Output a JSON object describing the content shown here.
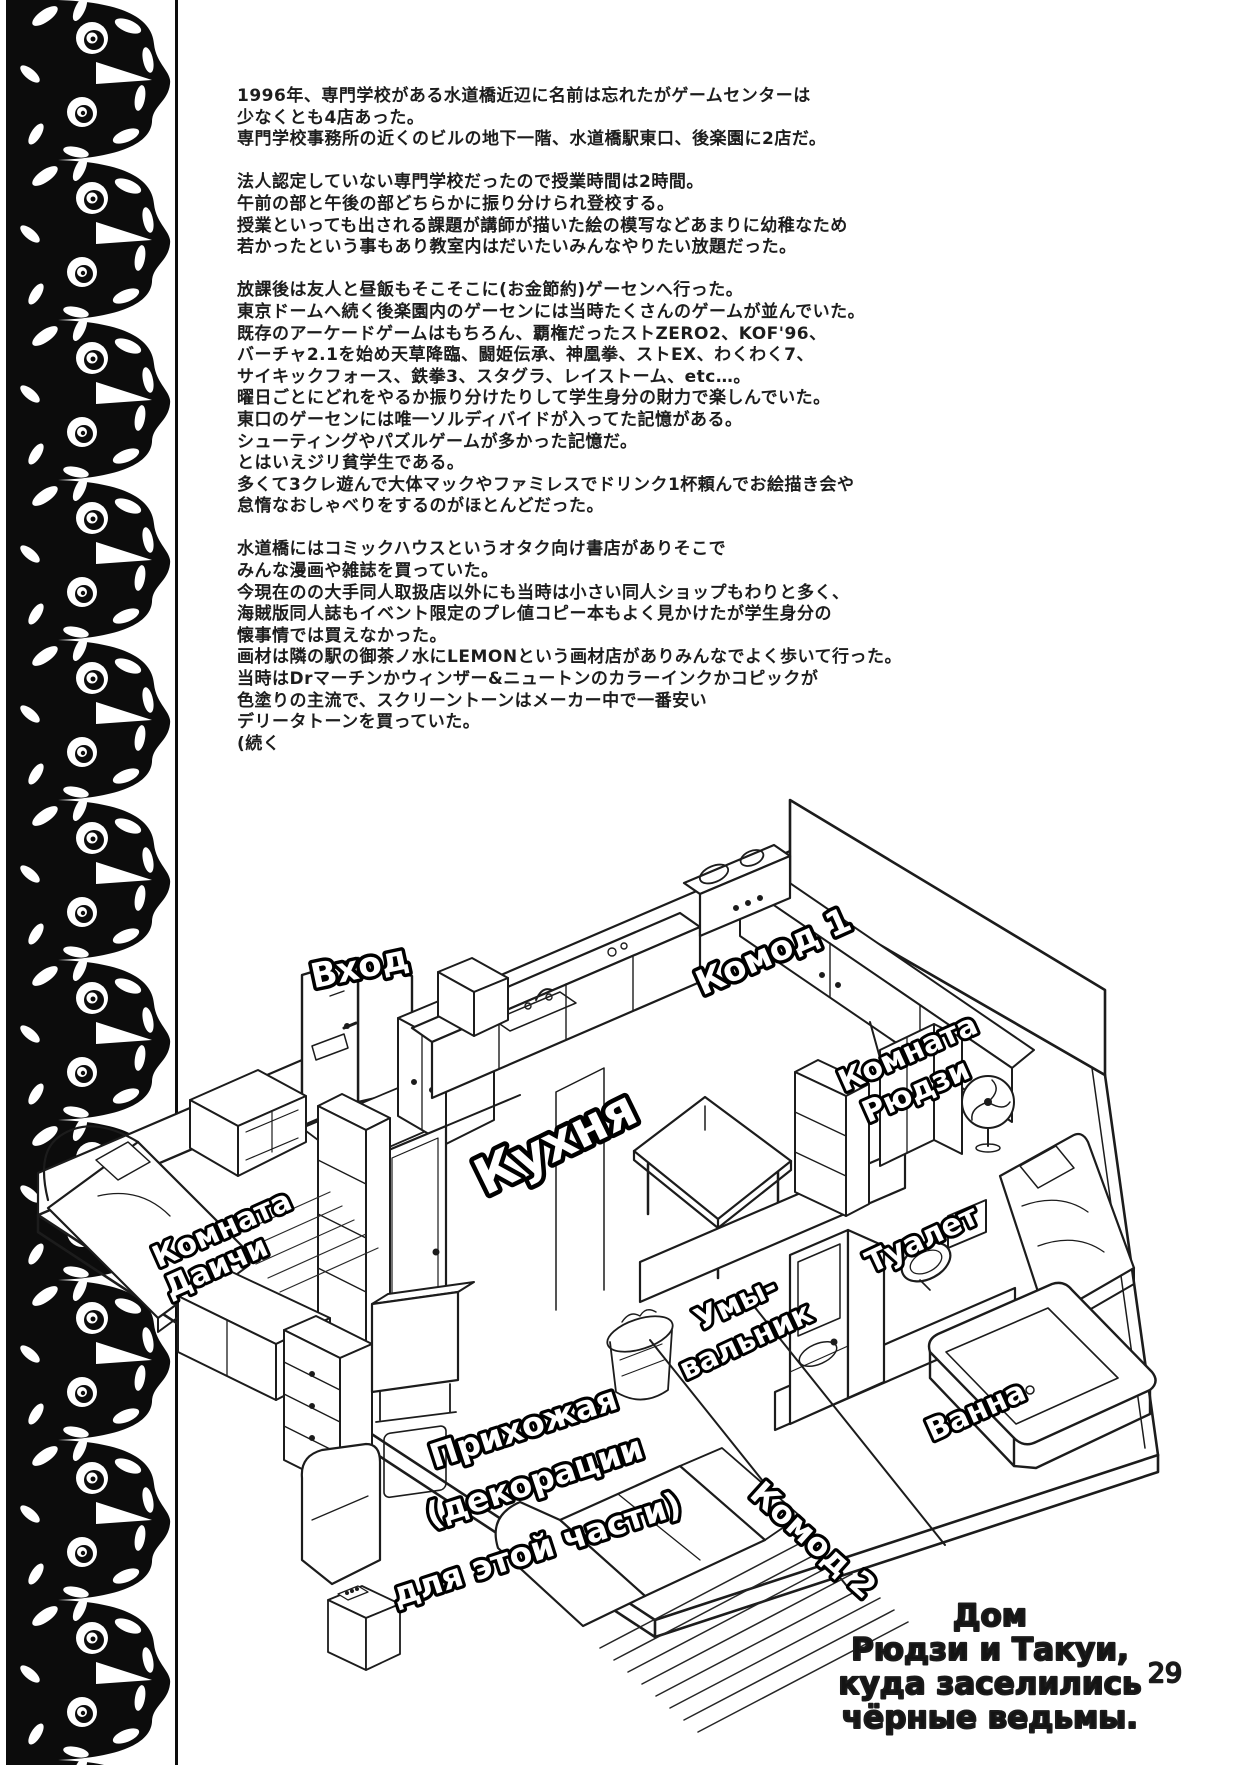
{
  "page": {
    "number": "29",
    "paper_color": "#ffffff",
    "ink_color": "#1c1c1c"
  },
  "column_text": {
    "lines": [
      "1996年、専門学校がある水道橋近辺に名前は忘れたがゲームセンターは",
      "少なくとも4店あった。",
      "専門学校事務所の近くのビルの地下一階、水道橋駅東口、後楽園に2店だ。",
      "",
      "法人認定していない専門学校だったので授業時間は2時間。",
      "午前の部と午後の部どちらかに振り分けられ登校する。",
      "授業といっても出される課題が講師が描いた絵の模写などあまりに幼稚なため",
      "若かったという事もあり教室内はだいたいみんなやりたい放題だった。",
      "",
      "放課後は友人と昼飯もそこそこに(お金節約)ゲーセンへ行った。",
      "東京ドームへ続く後楽園内のゲーセンには当時たくさんのゲームが並んでいた。",
      "既存のアーケードゲームはもちろん、覇権だったストZERO2、KOF'96、",
      "バーチャ2.1を始め天草降臨、闘姫伝承、神凰拳、ストEX、わくわく7、",
      "サイキックフォース、鉄拳3、スタグラ、レイストーム、etc…。",
      "曜日ごとにどれをやるか振り分けたりして学生身分の財力で楽しんでいた。",
      "東口のゲーセンには唯一ソルディバイドが入ってた記憶がある。",
      "シューティングやパズルゲームが多かった記憶だ。",
      "とはいえジリ貧学生である。",
      "多くて3クレ遊んで大体マックやファミレスでドリンク1杯頼んでお絵描き会や",
      "怠惰なおしゃべりをするのがほとんどだった。",
      "",
      "水道橋にはコミックハウスというオタク向け書店がありそこで",
      "みんな漫画や雑誌を買っていた。",
      "今現在のの大手同人取扱店以外にも当時は小さい同人ショップもわりと多く、",
      "海賊版同人誌もイベント限定のプレ値コピー本もよく見かけたが学生身分の",
      "懐事情では買えなかった。",
      "画材は隣の駅の御茶ノ水にLEMONという画材店がありみんなでよく歩いて行った。",
      "当時はDrマーチンかウィンザー&ニュートンのカラーインクかコピックが",
      "色塗りの主流で、スクリーントーンはメーカー中で一番安い",
      "デリータトーンを買っていた。",
      "(続く"
    ]
  },
  "floorplan": {
    "labels": {
      "entrance": "Вход",
      "dresser1": "Комод 1",
      "kitchen": "Кухня",
      "room_ryuji_line1": "Комната",
      "room_ryuji_line2": "Рюдзи",
      "room_daichi_line1": "Комната",
      "room_daichi_line2": "Даичи",
      "toilet": "Туалет",
      "sink_line1": "Умы-",
      "sink_line2": "вальник",
      "bath": "Ванна",
      "hallway_line1": "Прихожая",
      "hallway_line2": "(декорации",
      "hallway_line3": "для этой части)",
      "dresser2": "Комод 2"
    },
    "caption_lines": [
      "Дом",
      "Рюдзи и Такуи,",
      "куда заселились",
      "чёрные ведьмы."
    ]
  }
}
